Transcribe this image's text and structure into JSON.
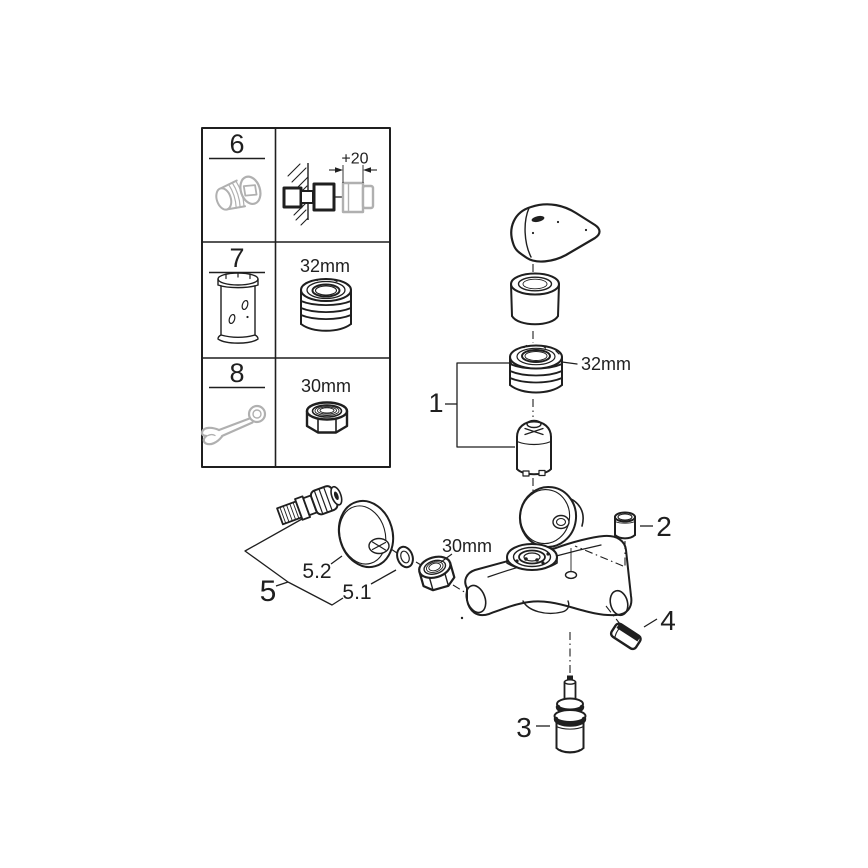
{
  "colors": {
    "line": "#1f1f1f",
    "gray": "#b0b0b0",
    "bg": "#ffffff"
  },
  "accessory_table": {
    "rows": [
      {
        "num": "6",
        "dim": "+20",
        "icon": "threaded-extension-nipple-icon"
      },
      {
        "num": "7",
        "dim": "32mm",
        "icon": "mounting-sleeve-tool-icon"
      },
      {
        "num": "8",
        "dim": "30mm",
        "icon": "open-end-wrench-icon"
      }
    ]
  },
  "diagram": {
    "callouts": {
      "c1": "1",
      "c2": "2",
      "c3": "3",
      "c4": "4",
      "c5": "5",
      "c5_1": "5.1",
      "c5_2": "5.2"
    },
    "dimensions": {
      "cartridge_ring_nut": "32mm",
      "union_nut": "30mm"
    }
  }
}
